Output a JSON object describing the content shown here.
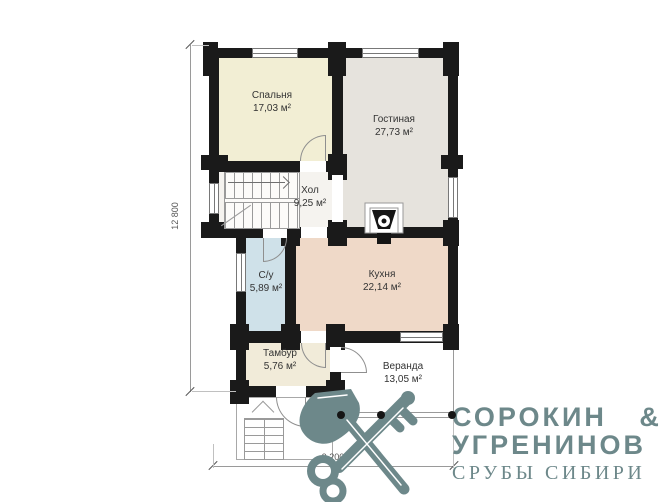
{
  "page": {
    "background": "#ffffff"
  },
  "plan": {
    "wall_color": "#1a1a1a",
    "line_color": "#8f8f8f",
    "rooms": [
      {
        "id": "bedroom",
        "name": "Спальня",
        "area": "17,03 м²",
        "color": "#f2eed4"
      },
      {
        "id": "living",
        "name": "Гостиная",
        "area": "27,73 м²",
        "color": "#e6e3dd"
      },
      {
        "id": "hall",
        "name": "Хол",
        "area": "9,25 м²",
        "color": "#f5f3ef"
      },
      {
        "id": "bathroom",
        "name": "С/у",
        "area": "5,89 м²",
        "color": "#cfe1e9"
      },
      {
        "id": "kitchen",
        "name": "Кухня",
        "area": "22,14 м²",
        "color": "#efd9c8"
      },
      {
        "id": "vestibule",
        "name": "Тамбур",
        "area": "5,76 м²",
        "color": "#f1ebd9"
      },
      {
        "id": "veranda",
        "name": "Веранда",
        "area": "13,05 м²",
        "color": "#ffffff"
      }
    ],
    "dimensions": {
      "left": "12 800",
      "bottom": "9 200"
    }
  },
  "logo": {
    "line1": "СОРОКИН &",
    "line2": "УГРЕНИНОВ",
    "line3": "СРУБЫ СИБИРИ",
    "color": "#6d888a",
    "icon": "axe-key-icon"
  }
}
